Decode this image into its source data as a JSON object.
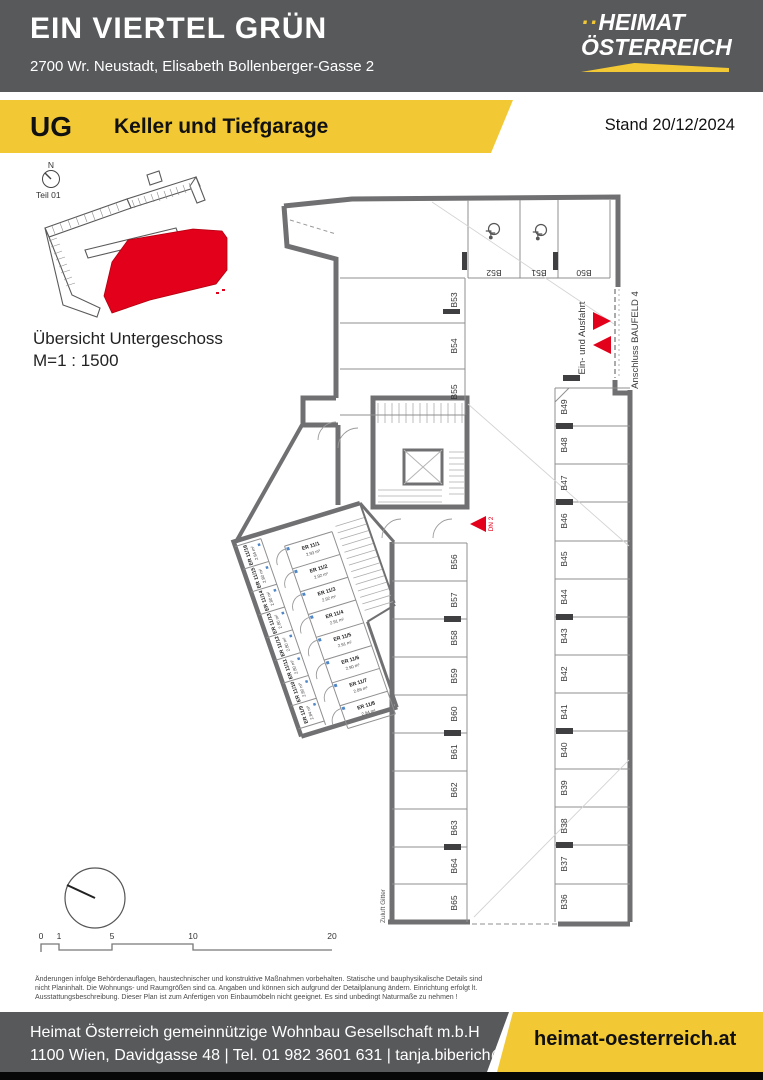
{
  "header": {
    "title": "EIN VIERTEL GRÜN",
    "address": "2700 Wr. Neustadt, Elisabeth Bollenberger-Gasse 2",
    "logo_dots": "··",
    "logo_line1": "HEIMAT",
    "logo_line2": "ÖSTERREICH"
  },
  "banner": {
    "level": "UG",
    "title": "Keller und Tiefgarage",
    "stand": "Stand 20/12/2024"
  },
  "overview": {
    "north": "N",
    "part": "Teil 01",
    "caption": "Übersicht Untergeschoss",
    "scale": "M=1 : 1500"
  },
  "plan": {
    "top_spots": [
      "B52",
      "B51",
      "B50"
    ],
    "left_upper_spots": [
      "B53",
      "B54",
      "B55"
    ],
    "left_lower_spots": [
      "B56",
      "B57",
      "B58",
      "B59",
      "B60",
      "B61",
      "B62",
      "B63",
      "B64",
      "B65"
    ],
    "right_spots": [
      "B49",
      "B48",
      "B47",
      "B46",
      "B45",
      "B44",
      "B43",
      "B42",
      "B41",
      "B40",
      "B39",
      "B38",
      "B37",
      "B36"
    ],
    "storage_right": [
      {
        "id": "ER 11/1",
        "area": "2.93 m²"
      },
      {
        "id": "ER 11/2",
        "area": "2.92 m²"
      },
      {
        "id": "ER 11/3",
        "area": "2.92 m²"
      },
      {
        "id": "ER 11/4",
        "area": "2.91 m²"
      },
      {
        "id": "ER 11/5",
        "area": "2.91 m²"
      },
      {
        "id": "ER 11/6",
        "area": "2.90 m²"
      },
      {
        "id": "ER 11/7",
        "area": "2.89 m²"
      },
      {
        "id": "ER 11/8",
        "area": "2.94 m²"
      }
    ],
    "storage_left": [
      {
        "id": "ER 11/16",
        "area": "2.94 m²"
      },
      {
        "id": "ER 11/15",
        "area": "2.80 m²"
      },
      {
        "id": "ER 11/14",
        "area": "2.80 m²"
      },
      {
        "id": "ER 11/13",
        "area": "2.80 m²"
      },
      {
        "id": "ER 11/12",
        "area": "2.80 m²"
      },
      {
        "id": "ER 11/11",
        "area": "2.80 m²"
      },
      {
        "id": "ER 11/10",
        "area": "2.80 m²"
      },
      {
        "id": "ER 11/9",
        "area": "2.84 m²"
      }
    ],
    "labels": {
      "entry": "Ein- und Ausfahrt",
      "connection": "Anschluss BAUFELD 4",
      "door": "DN 2",
      "vent": "Zuluft Gitter"
    }
  },
  "scalebar": {
    "ticks": [
      "0",
      "1",
      "5",
      "10",
      "20"
    ]
  },
  "disclaimer": {
    "lines": [
      "Änderungen infolge Behördenauflagen, haustechnischer und konstruktive Maßnahmen vorbehalten. Statische und bauphysikalische Details sind",
      "nicht Planinhalt. Die Wohnungs- und Raumgrößen sind ca. Angaben und können sich aufgrund der Detailplanung ändern. Einrichtung erfolgt lt.",
      "Ausstattungsbeschreibung. Dieser Plan ist zum Anfertigen von Einbaumöbeln nicht geeignet. Es sind unbedingt Naturmaße zu nehmen !"
    ]
  },
  "footer": {
    "company": "Heimat Österreich gemeinnützige Wohnbau Gesellschaft m.b.H",
    "contact": "1100 Wien, Davidgasse 48 | Tel. 01 982 3601 631 | tanja.biberich@hoe.at",
    "website": "heimat-oesterreich.at"
  },
  "colors": {
    "brand_yellow": "#F2C935",
    "header_gray": "#58595B",
    "accent_red": "#E2001A"
  }
}
